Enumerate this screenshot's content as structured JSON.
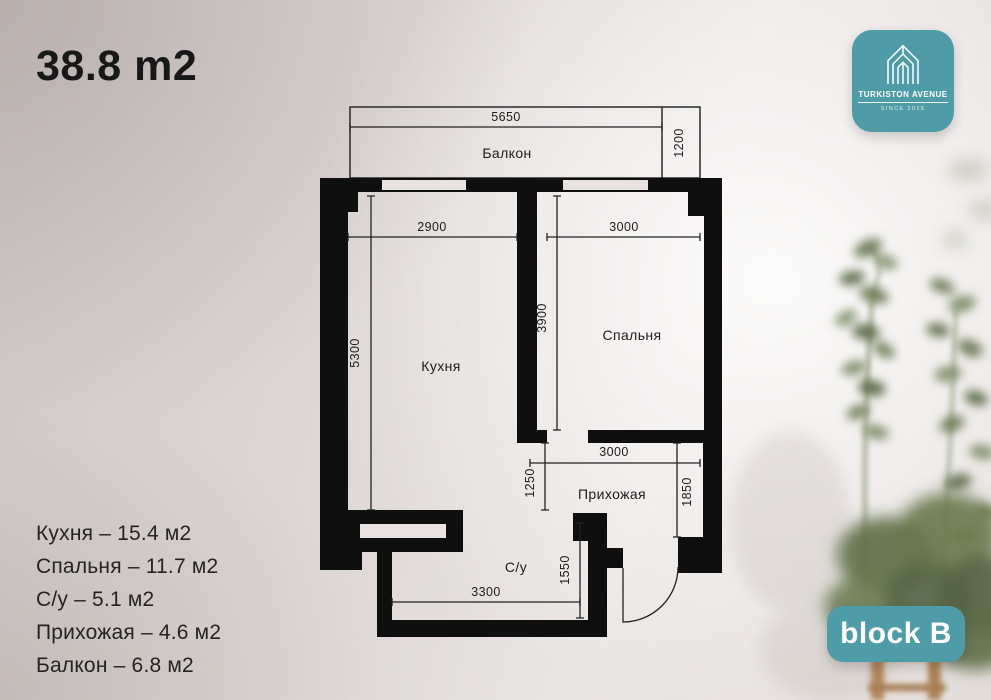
{
  "title": "38.8 m2",
  "logo": {
    "brand": "TURKISTON AVENUE",
    "since": "SINCE 2015"
  },
  "badge": {
    "label": "block B"
  },
  "legend": {
    "items": [
      "Кухня – 15.4 м2",
      "Спальня – 11.7 м2",
      "С/у – 5.1 м2",
      "Прихожая – 4.6 м2",
      "Балкон – 6.8 м2"
    ]
  },
  "plan": {
    "rooms": {
      "balcony": "Балкон",
      "kitchen": "Кухня",
      "bedroom": "Спальня",
      "hallway": "Прихожая",
      "bathroom": "С/у"
    },
    "dims": {
      "balcony_width": "5650",
      "balcony_depth": "1200",
      "kitchen_width": "2900",
      "bedroom_width": "3000",
      "kitchen_length": "5300",
      "bedroom_length": "3900",
      "hallway_width": "3000",
      "corridor_width": "1250",
      "hallway_length": "1850",
      "bathroom_length": "1550",
      "bathroom_width": "3300"
    }
  },
  "colors": {
    "teal": "#4d9ca7",
    "wall_black": "#0f0f0f",
    "background": "#e3ddda"
  }
}
